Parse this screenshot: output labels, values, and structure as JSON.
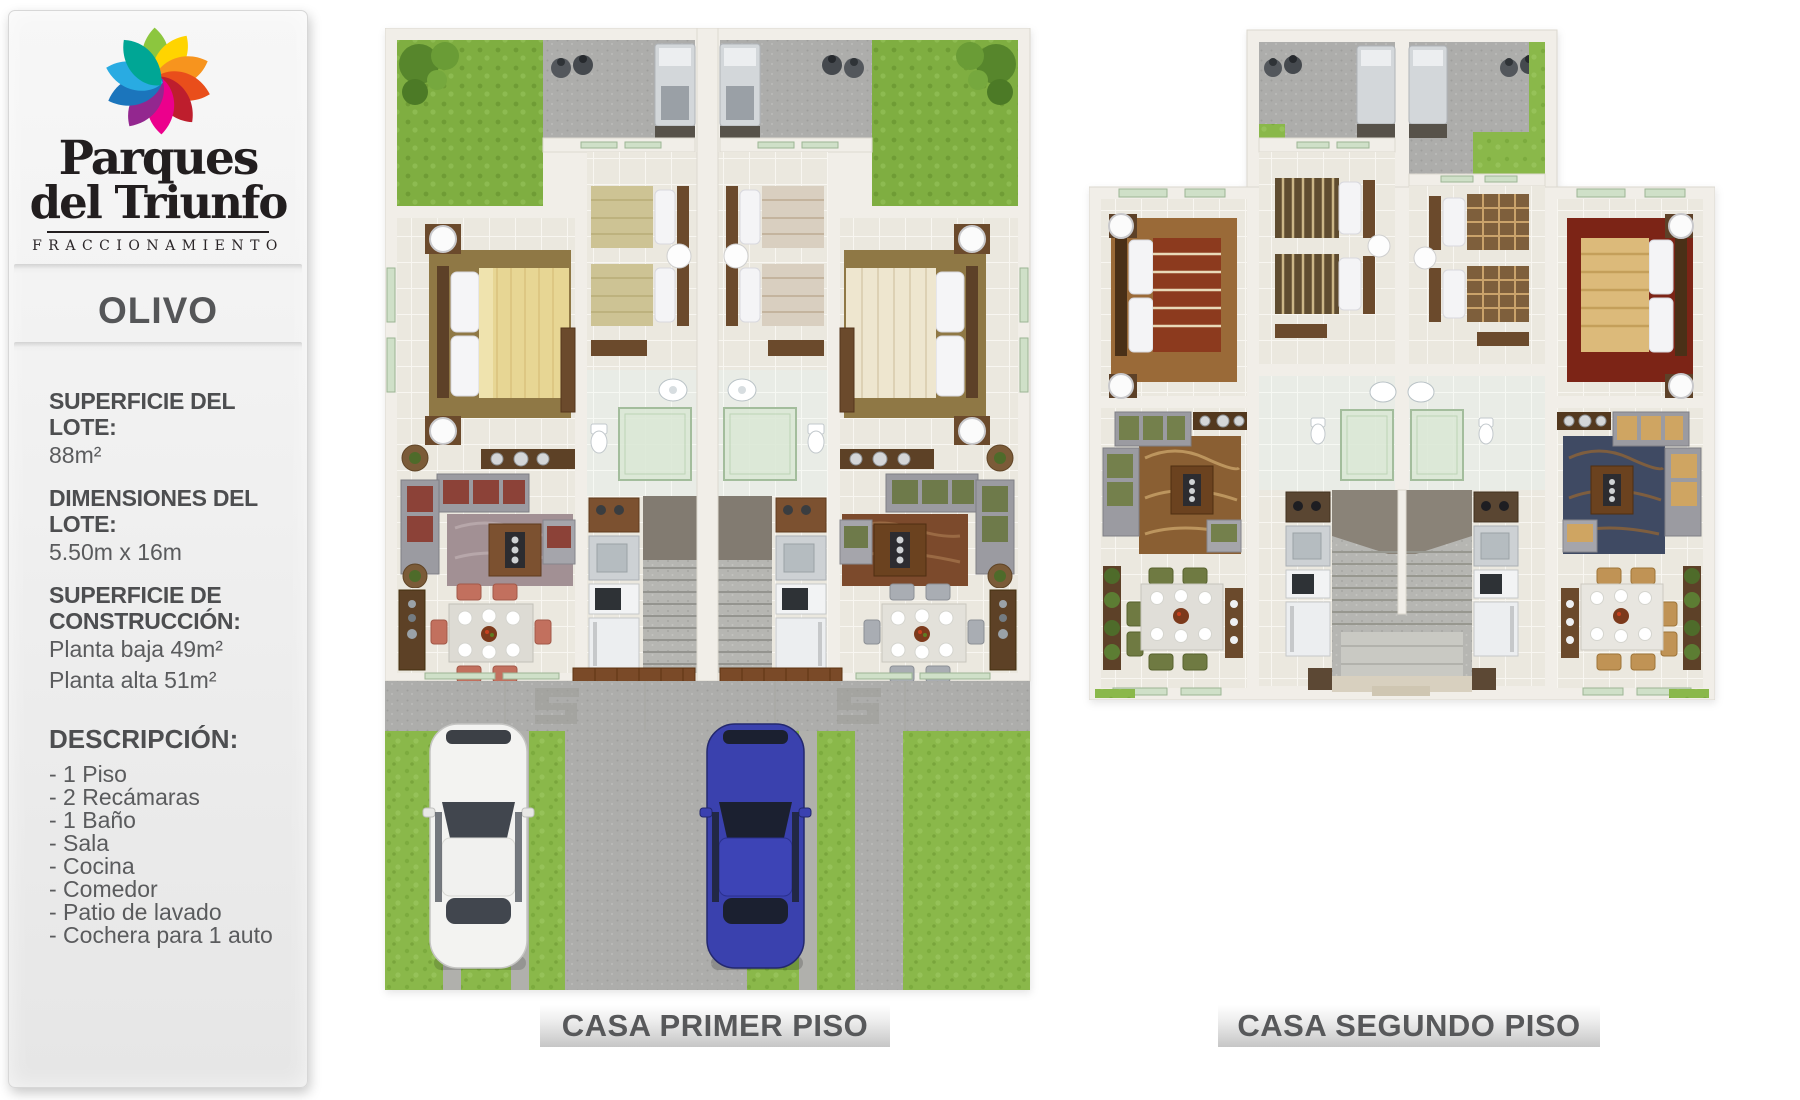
{
  "sidebar": {
    "logo": {
      "brand_line1": "Parques",
      "brand_line2": "del Triunfo",
      "subtitle": "FRACCIONAMIENTO",
      "petal_colors": [
        "#8cc63e",
        "#ffd400",
        "#f7941e",
        "#e94e1b",
        "#be1e2d",
        "#ec008c",
        "#93278f",
        "#1b75bc",
        "#29abe2",
        "#00a695"
      ]
    },
    "model_name": "OLIVO",
    "specs": [
      {
        "label": "SUPERFICIE DEL LOTE:",
        "value": "88m²"
      },
      {
        "label": "DIMENSIONES DEL LOTE:",
        "value": "5.50m x 16m"
      },
      {
        "label": "SUPERFICIE DE CONSTRUCCIÓN:",
        "value_line1": "Planta baja 49m²",
        "value_line2": "Planta alta 51m²"
      }
    ],
    "description": {
      "label": "DESCRIPCIÓN:",
      "items": [
        "- 1 Piso",
        "- 2 Recámaras",
        "- 1 Baño",
        "- Sala",
        "- Cocina",
        "- Comedor",
        "- Patio de lavado",
        "- Cochera para 1 auto"
      ]
    }
  },
  "plans": [
    {
      "caption": "CASA PRIMER PISO"
    },
    {
      "caption": "CASA SEGUNDO PISO"
    }
  ],
  "palette": {
    "caption_text": "#57585a",
    "caption_bg_top": "#ffffff",
    "caption_bg_bottom": "#c6c6c6",
    "sidebar_text": "#4d4e50",
    "sidebar_value": "#5a5b5d",
    "logo_text": "#221e1f",
    "grass": "#85b344",
    "concrete": "#b2b2ae",
    "wall": "#f1eee8",
    "tile": "#ebe8df",
    "wood": "#7c5130",
    "car_white": "#f3f3f1",
    "car_blue": "#3a41ae",
    "accent_red": "#8c4238",
    "accent_green": "#74804c",
    "accent_tan": "#cfa562"
  }
}
